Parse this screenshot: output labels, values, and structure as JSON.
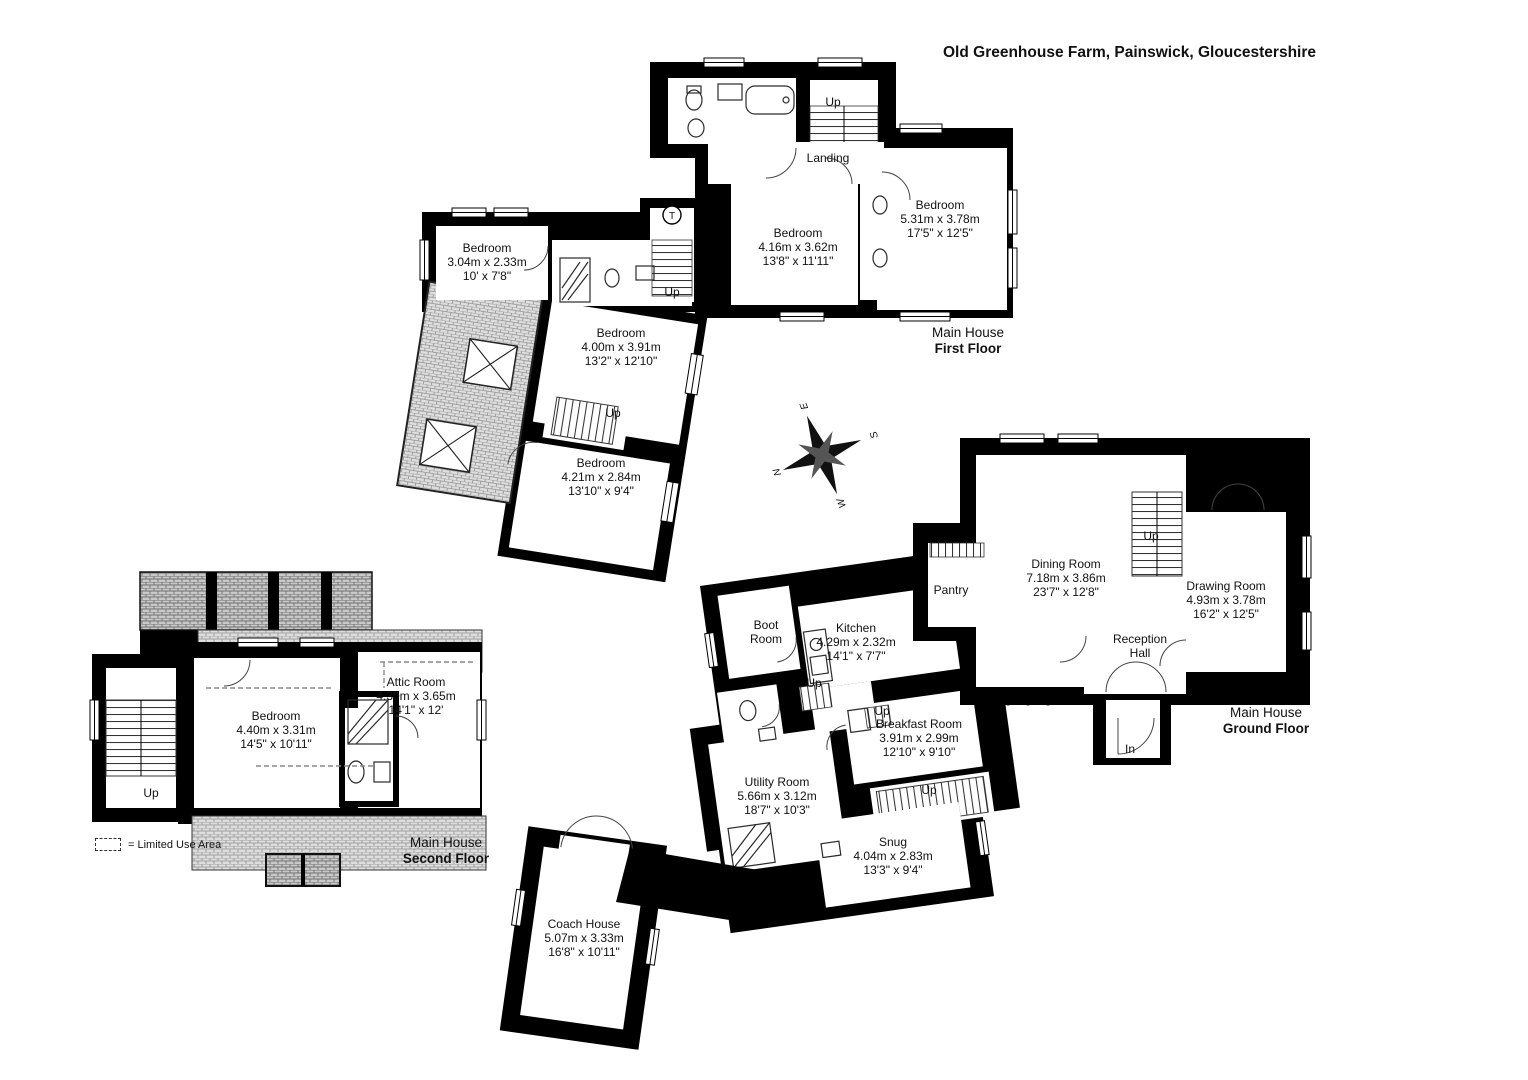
{
  "title": "Old Greenhouse Farm, Painswick, Gloucestershire",
  "legend": {
    "text": "= Limited Use Area"
  },
  "compass": {
    "n": "N",
    "e": "E",
    "s": "S",
    "w": "W"
  },
  "labels": {
    "up": "Up",
    "in": "In",
    "landing": "Landing",
    "tank": "T"
  },
  "floors": {
    "first": {
      "building": "Main House",
      "level": "First Floor"
    },
    "ground": {
      "building": "Main House",
      "level": "Ground Floor"
    },
    "second": {
      "building": "Main House",
      "level": "Second Floor"
    }
  },
  "rooms": {
    "bed_416": {
      "name": "Bedroom",
      "metric": "4.16m x 3.62m",
      "imperial": "13'8\" x 11'11\""
    },
    "bed_531": {
      "name": "Bedroom",
      "metric": "5.31m x 3.78m",
      "imperial": "17'5\" x 12'5\""
    },
    "bed_304": {
      "name": "Bedroom",
      "metric": "3.04m x 2.33m",
      "imperial": "10' x 7'8\""
    },
    "bed_400": {
      "name": "Bedroom",
      "metric": "4.00m x 3.91m",
      "imperial": "13'2\" x 12'10\""
    },
    "bed_421": {
      "name": "Bedroom",
      "metric": "4.21m x 2.84m",
      "imperial": "13'10\" x 9'4\""
    },
    "landing": {
      "name": "Landing"
    },
    "dining": {
      "name": "Dining Room",
      "metric": "7.18m x 3.86m",
      "imperial": "23'7\" x 12'8\""
    },
    "drawing": {
      "name": "Drawing Room",
      "metric": "4.93m x 3.78m",
      "imperial": "16'2\" x 12'5\""
    },
    "reception": {
      "name": "Reception Hall"
    },
    "pantry": {
      "name": "Pantry"
    },
    "boot": {
      "name": "Boot Room"
    },
    "kitchen": {
      "name": "Kitchen",
      "metric": "4.29m x 2.32m",
      "imperial": "14'1\" x 7'7\""
    },
    "breakfast": {
      "name": "Breakfast Room",
      "metric": "3.91m x 2.99m",
      "imperial": "12'10\" x 9'10\""
    },
    "utility": {
      "name": "Utility Room",
      "metric": "5.66m x 3.12m",
      "imperial": "18'7\" x 10'3\""
    },
    "snug": {
      "name": "Snug",
      "metric": "4.04m x 2.83m",
      "imperial": "13'3\" x 9'4\""
    },
    "bed_440": {
      "name": "Bedroom",
      "metric": "4.40m x 3.31m",
      "imperial": "14'5\" x 10'11\""
    },
    "attic": {
      "name": "Attic Room",
      "metric": "4.30m x 3.65m",
      "imperial": "14'1\" x 12'"
    },
    "coach": {
      "name": "Coach House",
      "metric": "5.07m x 3.33m",
      "imperial": "16'8\" x 10'11\""
    }
  },
  "colors": {
    "wall": "#000000",
    "room": "#ffffff",
    "roof_hatch": "#dedede",
    "roof_hatch_dark": "#cccccc",
    "background": "#ffffff"
  }
}
